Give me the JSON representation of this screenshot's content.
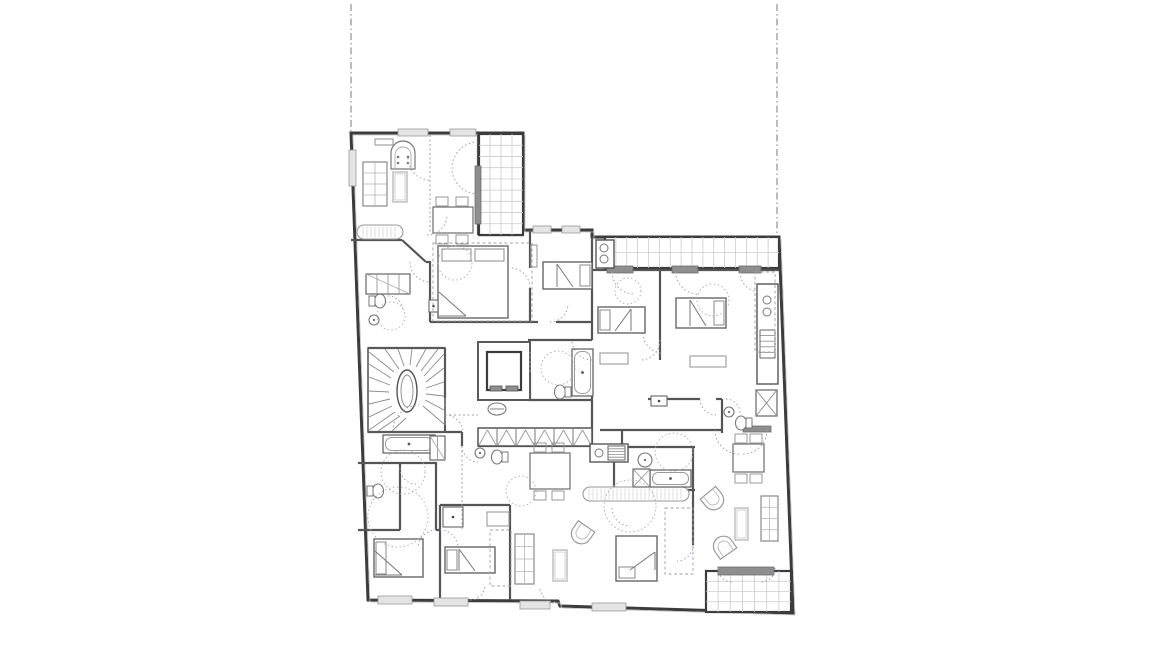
{
  "meta": {
    "canvas": {
      "w": 1156,
      "h": 650
    }
  },
  "plan": {
    "colors": {
      "wall": "#3c3c3c",
      "mid": "#6b6b6b",
      "light": "#9c9c9c",
      "lighter": "#c4c4c4",
      "grid": "#cccccc",
      "dark_fill": "#8e8e8e",
      "arc": "#9aa0b6",
      "dash": "#a0a0a0"
    },
    "boundary_lines": [
      {
        "name": "property-line-left",
        "x1": 351,
        "y1": 4,
        "x2": 351,
        "y2": 131
      },
      {
        "name": "property-line-right",
        "x1": 777,
        "y1": 4,
        "x2": 777,
        "y2": 256
      }
    ],
    "outline": {
      "name": "building-outline",
      "d": "M351,133 L523,133 L523,230 L592,230 L592,237 L779,237 L793,613 L560,606 L558,601 L368,600 Z"
    },
    "walls": [
      [
        351,
        240,
        402,
        240
      ],
      [
        402,
        240,
        426,
        262
      ],
      [
        426,
        262,
        431,
        262
      ],
      [
        430,
        262,
        430,
        322
      ],
      [
        430,
        322,
        538,
        322
      ],
      [
        556,
        322,
        592,
        322
      ],
      [
        530,
        230,
        530,
        268
      ],
      [
        530,
        288,
        530,
        322
      ],
      [
        478,
        135,
        478,
        235
      ],
      [
        478,
        235,
        523,
        235
      ],
      [
        592,
        237,
        592,
        340
      ],
      [
        592,
        360,
        592,
        428
      ],
      [
        592,
        428,
        592,
        446
      ],
      [
        528,
        340,
        592,
        340
      ],
      [
        530,
        372,
        530,
        400
      ],
      [
        528,
        400,
        592,
        400
      ],
      [
        478,
        398,
        530,
        398
      ],
      [
        368,
        348,
        445,
        348
      ],
      [
        445,
        348,
        445,
        398
      ],
      [
        445,
        425,
        445,
        432
      ],
      [
        368,
        432,
        462,
        432
      ],
      [
        462,
        432,
        462,
        446
      ],
      [
        478,
        446,
        592,
        446
      ],
      [
        358,
        463,
        436,
        463
      ],
      [
        400,
        463,
        400,
        530
      ],
      [
        358,
        530,
        400,
        530
      ],
      [
        436,
        462,
        436,
        530
      ],
      [
        436,
        530,
        440,
        530
      ],
      [
        440,
        505,
        510,
        505
      ],
      [
        440,
        505,
        440,
        600
      ],
      [
        510,
        505,
        510,
        600
      ],
      [
        600,
        430,
        722,
        430
      ],
      [
        622,
        430,
        622,
        447
      ],
      [
        614,
        447,
        695,
        447
      ],
      [
        614,
        447,
        614,
        490
      ],
      [
        614,
        490,
        695,
        490
      ],
      [
        693,
        447,
        693,
        545
      ],
      [
        660,
        270,
        660,
        360
      ],
      [
        648,
        399,
        700,
        399
      ],
      [
        716,
        399,
        722,
        399
      ],
      [
        722,
        399,
        722,
        433
      ],
      [
        592,
        270,
        607,
        270
      ],
      [
        633,
        270,
        672,
        270
      ],
      [
        698,
        270,
        739,
        270
      ],
      [
        761,
        270,
        779,
        270
      ]
    ],
    "windows": [
      {
        "x": 398,
        "y": 129,
        "w": 30,
        "h": 7,
        "tone": "light"
      },
      {
        "x": 450,
        "y": 129,
        "w": 26,
        "h": 7,
        "tone": "light"
      },
      {
        "x": 533,
        "y": 226,
        "w": 18,
        "h": 7,
        "tone": "light"
      },
      {
        "x": 562,
        "y": 226,
        "w": 18,
        "h": 7,
        "tone": "light"
      },
      {
        "x": 349,
        "y": 150,
        "w": 7,
        "h": 36,
        "tone": "light"
      },
      {
        "x": 378,
        "y": 596,
        "w": 34,
        "h": 8,
        "tone": "light"
      },
      {
        "x": 434,
        "y": 598,
        "w": 34,
        "h": 8,
        "tone": "light"
      },
      {
        "x": 520,
        "y": 601,
        "w": 30,
        "h": 8,
        "tone": "light"
      },
      {
        "x": 592,
        "y": 603,
        "w": 34,
        "h": 8,
        "tone": "light"
      },
      {
        "x": 607,
        "y": 266,
        "w": 26,
        "h": 7,
        "tone": "dark"
      },
      {
        "x": 672,
        "y": 266,
        "w": 26,
        "h": 7,
        "tone": "dark"
      },
      {
        "x": 739,
        "y": 266,
        "w": 22,
        "h": 7,
        "tone": "dark"
      },
      {
        "x": 718,
        "y": 567,
        "w": 56,
        "h": 8,
        "tone": "dark"
      },
      {
        "x": 743,
        "y": 426,
        "w": 28,
        "h": 6,
        "tone": "dark"
      },
      {
        "x": 475,
        "y": 166,
        "w": 6,
        "h": 58,
        "tone": "dark"
      }
    ],
    "balconies": [
      {
        "name": "loggia-top-left",
        "x": 479,
        "y": 134,
        "w": 44,
        "h": 101,
        "cols": 4,
        "rows": 9
      },
      {
        "name": "balcony-top",
        "x": 605,
        "y": 237,
        "w": 174,
        "h": 31,
        "cols": 16,
        "rows": 2
      },
      {
        "name": "balcony-bottom-right",
        "x": 706,
        "y": 571,
        "w": 85,
        "h": 41,
        "cols": 7,
        "rows": 4
      }
    ],
    "stair": {
      "name": "winder-staircase",
      "x": 368,
      "y": 348,
      "w": 77,
      "h": 84,
      "core": {
        "cx": 407,
        "cy": 391,
        "rx": 10,
        "ry": 21
      },
      "treads": [
        [
          394,
          372,
          369,
          352
        ],
        [
          391,
          378,
          369,
          364
        ],
        [
          390,
          385,
          369,
          377
        ],
        [
          389,
          392,
          369,
          391
        ],
        [
          390,
          399,
          369,
          404
        ],
        [
          392,
          406,
          369,
          417
        ],
        [
          395,
          412,
          369,
          430
        ],
        [
          400,
          416,
          378,
          431
        ],
        [
          406,
          418,
          392,
          431
        ],
        [
          399,
          369,
          385,
          349
        ],
        [
          404,
          366,
          398,
          349
        ],
        [
          410,
          365,
          412,
          349
        ],
        [
          416,
          367,
          426,
          349
        ],
        [
          421,
          371,
          438,
          349
        ],
        [
          424,
          376,
          444,
          354
        ],
        [
          426,
          382,
          444,
          368
        ],
        [
          426,
          388,
          444,
          382
        ],
        [
          426,
          394,
          444,
          396
        ],
        [
          425,
          400,
          444,
          410
        ],
        [
          423,
          406,
          444,
          424
        ]
      ]
    },
    "elevator": {
      "name": "elevator",
      "x": 478,
      "y": 342,
      "w": 52,
      "h": 58,
      "cab": {
        "x": 487,
        "y": 352,
        "w": 34,
        "h": 38
      },
      "bits": [
        {
          "x": 490,
          "y": 386,
          "w": 12,
          "h": 5
        },
        {
          "x": 506,
          "y": 386,
          "w": 12,
          "h": 5
        }
      ]
    },
    "wardrobe": {
      "name": "wardrobe-row",
      "x": 478,
      "y": 428,
      "w": 114,
      "h": 18,
      "cells": 6
    },
    "beds": [
      {
        "name": "bed-double-1",
        "x": 438,
        "y": 246,
        "w": 70,
        "h": 72,
        "pillow": "top",
        "fold": "bl"
      },
      {
        "name": "bed-single-1",
        "x": 543,
        "y": 262,
        "w": 49,
        "h": 27,
        "pillow": "right",
        "fold": "left"
      },
      {
        "name": "bed-single-2",
        "x": 598,
        "y": 307,
        "w": 47,
        "h": 26,
        "pillow": "left",
        "fold": "right"
      },
      {
        "name": "bed-double-2",
        "x": 676,
        "y": 298,
        "w": 50,
        "h": 30,
        "pillow": "right",
        "fold": "left"
      },
      {
        "name": "bed-double-3",
        "x": 374,
        "y": 539,
        "w": 49,
        "h": 38,
        "pillow": "left",
        "fold": "bl"
      },
      {
        "name": "bed-single-3",
        "x": 445,
        "y": 547,
        "w": 50,
        "h": 26,
        "pillow": "left",
        "fold": "left"
      },
      {
        "name": "bed-single-4",
        "x": 616,
        "y": 536,
        "w": 41,
        "h": 45,
        "pillow": "bottom",
        "fold": "tr"
      }
    ],
    "tables": [
      {
        "name": "dining-table-1",
        "x": 433,
        "y": 207,
        "w": 40,
        "h": 26,
        "chairs": [
          {
            "dx": 3,
            "dy": -10
          },
          {
            "dx": 23,
            "dy": -10
          },
          {
            "dx": 3,
            "dy": 28
          },
          {
            "dx": 23,
            "dy": 28
          }
        ]
      },
      {
        "name": "dining-table-2",
        "x": 530,
        "y": 453,
        "w": 40,
        "h": 36,
        "chairs": [
          {
            "dx": 4,
            "dy": -10
          },
          {
            "dx": 22,
            "dy": -10
          },
          {
            "dx": 4,
            "dy": 38
          },
          {
            "dx": 22,
            "dy": 38
          }
        ]
      },
      {
        "name": "dining-table-3",
        "x": 733,
        "y": 444,
        "w": 31,
        "h": 28,
        "chairs": [
          {
            "dx": 2,
            "dy": -10
          },
          {
            "dx": 17,
            "dy": -10
          },
          {
            "dx": 2,
            "dy": 30
          },
          {
            "dx": 17,
            "dy": 30
          }
        ]
      }
    ],
    "sofas": [
      {
        "name": "sofa-1",
        "x": 363,
        "y": 162,
        "w": 24,
        "h": 44
      },
      {
        "name": "sofa-2",
        "x": 515,
        "y": 534,
        "w": 19,
        "h": 50
      },
      {
        "name": "sofa-3",
        "x": 761,
        "y": 496,
        "w": 17,
        "h": 45
      }
    ],
    "benches": [
      {
        "name": "bench-1",
        "x": 357,
        "y": 225,
        "w": 46,
        "h": 14
      },
      {
        "name": "bench-2",
        "x": 583,
        "y": 487,
        "w": 106,
        "h": 14
      }
    ],
    "tubs": [
      {
        "name": "bathtub-1",
        "x": 572,
        "y": 349,
        "w": 21,
        "h": 47
      },
      {
        "name": "bathtub-2",
        "x": 383,
        "y": 435,
        "w": 52,
        "h": 18
      },
      {
        "name": "bathtub-3",
        "x": 650,
        "y": 470,
        "w": 41,
        "h": 17
      }
    ],
    "wcs": [
      {
        "name": "toilet-1",
        "x": 380,
        "y": 301,
        "tank": "w"
      },
      {
        "name": "toilet-2",
        "x": 378,
        "y": 491,
        "tank": "w"
      },
      {
        "name": "toilet-3",
        "x": 560,
        "y": 392,
        "tank": "e"
      },
      {
        "name": "toilet-4",
        "x": 497,
        "y": 457,
        "tank": "e"
      },
      {
        "name": "toilet-5",
        "x": 741,
        "y": 423,
        "tank": "e"
      }
    ],
    "sinks": [
      {
        "name": "sink-1",
        "x": 374,
        "y": 320,
        "r": 5
      },
      {
        "name": "sink-2",
        "x": 480,
        "y": 453,
        "r": 5
      },
      {
        "name": "sink-3",
        "x": 645,
        "y": 460,
        "r": 7
      },
      {
        "name": "sink-4",
        "x": 729,
        "y": 412,
        "r": 5
      }
    ],
    "counters": [
      {
        "name": "kitchen-counter-right",
        "x": 757,
        "y": 284,
        "w": 21,
        "h": 100,
        "hob": {
          "x": 760,
          "y": 330,
          "w": 15,
          "h": 28
        },
        "circles": [
          {
            "cx": 767,
            "cy": 300,
            "r": 4
          },
          {
            "cx": 767,
            "cy": 312,
            "r": 4
          }
        ]
      },
      {
        "name": "kitchen-counter-center",
        "x": 590,
        "y": 444,
        "w": 38,
        "h": 18,
        "hob": {
          "x": 608,
          "y": 446,
          "w": 17,
          "h": 14
        },
        "circles": [
          {
            "cx": 599,
            "cy": 453,
            "r": 4
          }
        ]
      },
      {
        "name": "kitchenette-top",
        "x": 596,
        "y": 240,
        "w": 18,
        "h": 28,
        "hob": null,
        "circles": [
          {
            "cx": 604,
            "cy": 248,
            "r": 4
          },
          {
            "cx": 604,
            "cy": 259,
            "r": 4
          }
        ]
      }
    ],
    "cabinets": [
      {
        "name": "cabinet-1",
        "x": 366,
        "y": 274,
        "w": 44,
        "h": 20,
        "lines": 3
      },
      {
        "name": "cabinet-2",
        "x": 430,
        "y": 436,
        "w": 15,
        "h": 24,
        "lines": 1
      }
    ],
    "armchairs": [
      {
        "name": "armchair-1",
        "x": 582,
        "y": 533,
        "rot": 215
      },
      {
        "name": "armchair-2",
        "x": 713,
        "y": 499,
        "rot": 140
      },
      {
        "name": "armchair-3",
        "x": 724,
        "y": 547,
        "rot": 325
      }
    ],
    "coffee_tables": [
      {
        "name": "coffee-table-1",
        "x": 393,
        "y": 172,
        "w": 14,
        "h": 30
      },
      {
        "name": "coffee-table-2",
        "x": 553,
        "y": 550,
        "w": 14,
        "h": 31
      },
      {
        "name": "coffee-table-3",
        "x": 735,
        "y": 508,
        "w": 13,
        "h": 32
      }
    ],
    "stove": {
      "name": "tiled-stove",
      "x": 391,
      "y": 143,
      "w": 24,
      "h": 26
    },
    "washer": {
      "name": "washing-machine",
      "x": 633,
      "y": 469,
      "w": 17,
      "h": 18
    },
    "ducts": [
      {
        "name": "shaft-duct-1",
        "x": 756,
        "y": 390,
        "w": 21,
        "h": 26
      }
    ],
    "panels": [
      {
        "name": "wall-panel-1",
        "x": 429,
        "y": 300,
        "w": 9,
        "h": 12
      },
      {
        "name": "wall-panel-2",
        "x": 651,
        "y": 396,
        "w": 16,
        "h": 10
      },
      {
        "name": "wall-panel-3",
        "x": 443,
        "y": 507,
        "w": 20,
        "h": 20
      }
    ],
    "side_tables": [
      {
        "name": "side-table-1",
        "x": 600,
        "y": 353,
        "w": 28,
        "h": 11
      },
      {
        "name": "side-table-2",
        "x": 690,
        "y": 356,
        "w": 36,
        "h": 11
      },
      {
        "name": "side-table-3",
        "x": 487,
        "y": 512,
        "w": 22,
        "h": 14
      },
      {
        "name": "side-table-4",
        "x": 531,
        "y": 245,
        "w": 6,
        "h": 22
      },
      {
        "name": "wall-shelf-1",
        "x": 375,
        "y": 139,
        "w": 18,
        "h": 6
      }
    ],
    "vent": {
      "name": "vent-symbol",
      "cx": 497,
      "cy": 409,
      "rx": 9,
      "ry": 6
    },
    "dashed_rects": [
      {
        "name": "closet-dashed-1",
        "x": 665,
        "y": 508,
        "w": 28,
        "h": 66
      },
      {
        "name": "cupboard-dashed-2",
        "x": 755,
        "y": 272,
        "w": 20,
        "h": 80
      },
      {
        "name": "closet-dashed-3",
        "x": 490,
        "y": 530,
        "w": 21,
        "h": 56
      },
      {
        "name": "clearance-dashed-4",
        "x": 433,
        "y": 243,
        "w": 99,
        "h": 78
      }
    ],
    "dotted_lines": [
      [
        430,
        135,
        430,
        233
      ],
      [
        445,
        415,
        478,
        415
      ],
      [
        462,
        446,
        462,
        530
      ],
      [
        530,
        352,
        530,
        372
      ]
    ],
    "door_arcs": [
      "M408,158 A22,22 0 0 0 430,180",
      "M427,235 A20,20 0 0 0 447,215",
      "M410,262 A20,20 0 0 0 430,282",
      "M478,142 A26,26 0 0 0 452,168",
      "M478,194 A26,26 0 0 1 452,168",
      "M530,288 A20,20 0 0 0 510,268",
      "M550,322 A18,18 0 0 0 568,304",
      "M592,360 A20,20 0 0 1 572,340",
      "M643,333 A20,20 0 0 0 663,353",
      "M660,340 A20,20 0 0 1 640,360",
      "M612,272 A22,22 0 0 0 634,294",
      "M676,272 A22,22 0 0 0 698,294",
      "M740,272 A20,20 0 0 0 760,292",
      "M700,399 A16,16 0 0 0 716,415",
      "M726,399 A14,14 0 0 1 740,413",
      "M462,446 A16,16 0 0 0 478,462",
      "M445,415 A18,18 0 0 1 463,433",
      "M400,468 A16,16 0 0 0 416,484",
      "M440,530 A18,18 0 0 1 458,548",
      "M436,530 A18,18 0 0 0 418,548",
      "M470,600 A15,15 0 0 0 485,585",
      "M555,602 A15,15 0 0 1 540,587",
      "M715,430 A24,24 0 0 0 739,454",
      "M767,430 A24,24 0 0 1 743,454",
      "M718,568 A14,14 0 0 0 732,582",
      "M775,568 A14,14 0 0 1 761,582",
      "M612,508 A18,18 0 0 0 630,526",
      "M693,545 A16,16 0 0 1 677,561",
      "M388,296 A15,15 0 0 1 403,311",
      "M393,431 A26,26 0 0 1 419,405"
    ],
    "clearance_circles": [
      {
        "cx": 455,
        "cy": 263,
        "r": 17
      },
      {
        "cx": 391,
        "cy": 316,
        "r": 14
      },
      {
        "cx": 558,
        "cy": 368,
        "r": 17
      },
      {
        "cx": 628,
        "cy": 291,
        "r": 13
      },
      {
        "cx": 403,
        "cy": 472,
        "r": 22
      },
      {
        "cx": 398,
        "cy": 517,
        "r": 30
      },
      {
        "cx": 521,
        "cy": 491,
        "r": 15
      },
      {
        "cx": 630,
        "cy": 506,
        "r": 26
      },
      {
        "cx": 674,
        "cy": 452,
        "r": 19
      },
      {
        "cx": 713,
        "cy": 300,
        "r": 16
      }
    ]
  }
}
